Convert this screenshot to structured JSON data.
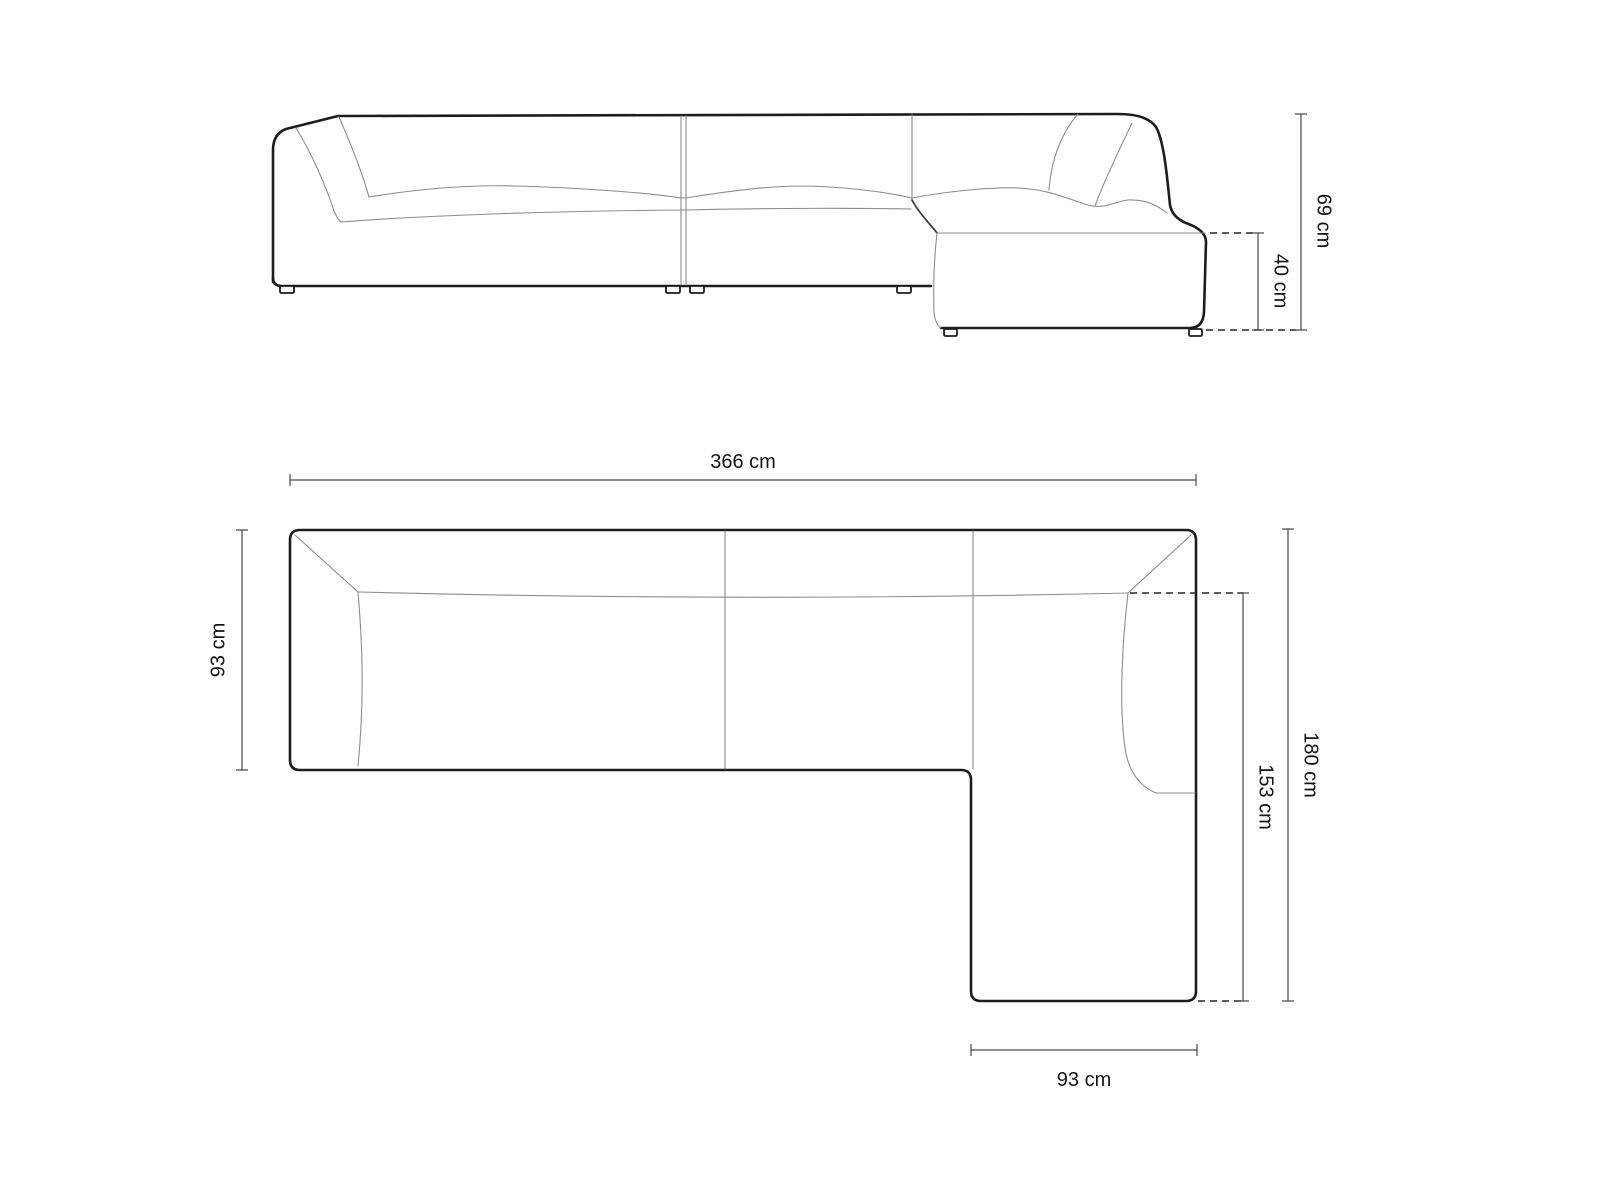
{
  "diagram": {
    "unit": "cm",
    "background_color": "#ffffff",
    "outline_color": "#1d1d1d",
    "thin_line_color": "#8c8c8c",
    "dimension_line_color": "#4a4a4a",
    "label_color": "#141414"
  },
  "elevation_view": {
    "dims": {
      "total_height": "69 cm",
      "seat_height": "40 cm"
    }
  },
  "plan_view": {
    "dims": {
      "total_width": "366 cm",
      "side_depth": "93 cm",
      "total_depth": "180 cm",
      "chaise_length": "153 cm",
      "chaise_width": "93 cm"
    }
  }
}
